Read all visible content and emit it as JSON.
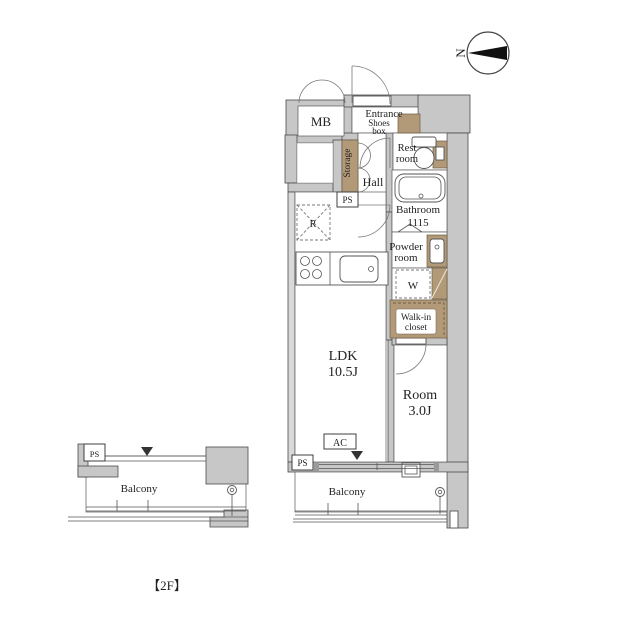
{
  "floorplan": {
    "floor_label": "【2F】",
    "compass": {
      "north_label": "N"
    },
    "rooms": {
      "mb": "MB",
      "entrance": "Entrance",
      "shoes_box": {
        "line1": "Shoes",
        "line2": "box"
      },
      "storage": "Storage",
      "hall": "Hall",
      "rest_room": {
        "line1": "Rest",
        "line2": "room"
      },
      "bathroom": {
        "line1": "Bathroom",
        "line2": "1115"
      },
      "powder_room": {
        "line1": "Powder",
        "line2": "room"
      },
      "washer": "W",
      "walk_in_closet": {
        "line1": "Walk-in",
        "line2": "closet"
      },
      "ldk": {
        "line1": "LDK",
        "line2": "10.5J"
      },
      "room": {
        "line1": "Room",
        "line2": "3.0J"
      },
      "balcony_main": "Balcony",
      "balcony_left": "Balcony",
      "refrigerator": "R"
    },
    "labels": {
      "ps1": "PS",
      "ps2": "PS",
      "ps3": "PS",
      "ac": "AC"
    },
    "colors": {
      "wall": "#c7c7c7",
      "accent_brown": "#b29a79",
      "line": "#4a4a4a",
      "background": "#ffffff"
    }
  }
}
